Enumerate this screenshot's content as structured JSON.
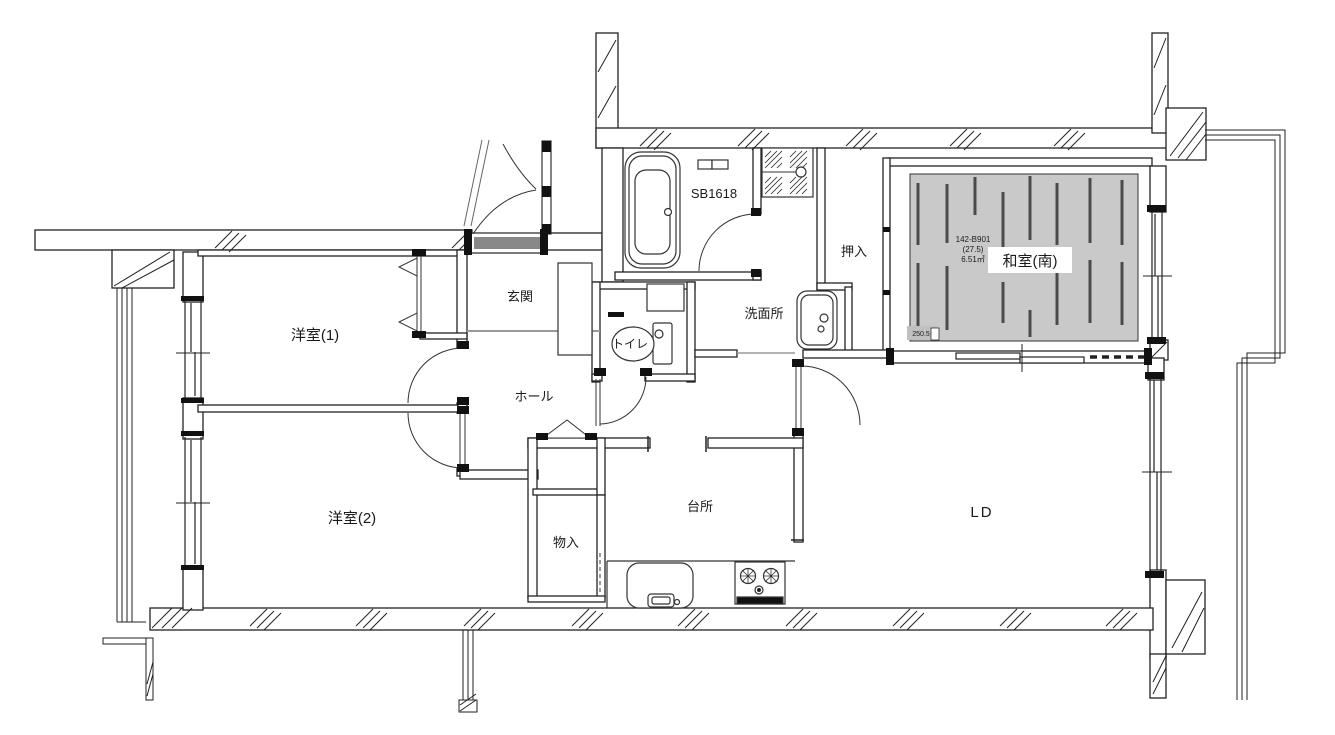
{
  "canvas": {
    "background": "#ffffff",
    "wall_color": "#222222",
    "tatami_fill": "#c9c9c9",
    "tatami_seam_color": "#4a4a4a",
    "step_line_color": "#999999"
  },
  "labels": {
    "western1": "洋室(1)",
    "western2": "洋室(2)",
    "entrance": "玄関",
    "hall": "ホール",
    "toilet": "トイレ",
    "bath_unit": "SB1618",
    "washroom": "洗面所",
    "closet": "押入",
    "japanese_room": "和室(南)",
    "kitchen": "台所",
    "living_dining": "LD",
    "storage": "物入"
  },
  "annotations": {
    "unit_code": "142-B901",
    "area_tsubo": "(27.5)",
    "area_m2": "6.51㎡",
    "dimension": "250.5"
  }
}
